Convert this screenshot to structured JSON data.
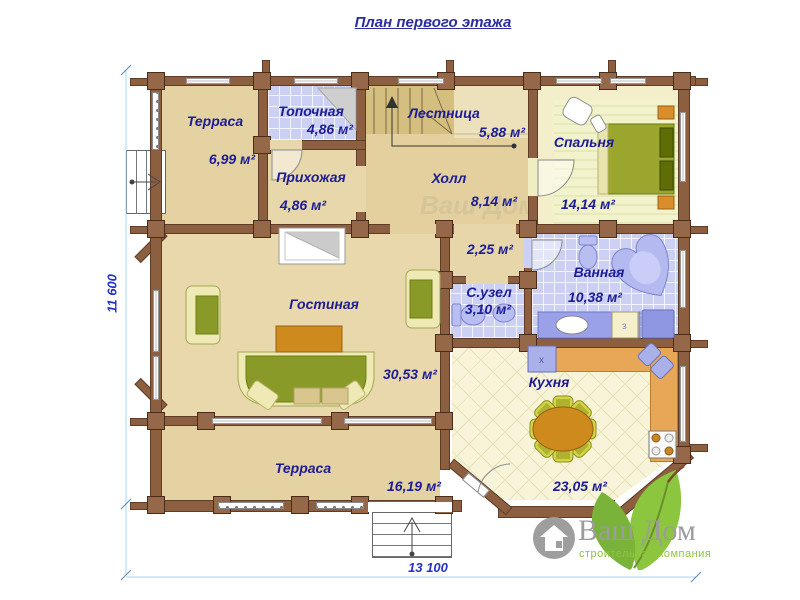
{
  "title": "План первого этажа",
  "dimension_labels": {
    "vertical": "11 600",
    "horizontal": "13 100"
  },
  "rooms": {
    "terrace_top": {
      "name": "Терраса",
      "area": "6,99 м²"
    },
    "boiler": {
      "name": "Топочная",
      "area": "4,86 м²"
    },
    "entry_hall": {
      "name": "Прихожая",
      "area": "4,86 м²"
    },
    "stairs": {
      "name": "Лестница",
      "area": "5,88 м²"
    },
    "hall": {
      "name": "Холл",
      "area": "8,14 м²"
    },
    "bedroom": {
      "name": "Спальня",
      "area": "14,14 м²"
    },
    "corridor": {
      "area": "2,25 м²"
    },
    "wc": {
      "name": "С.узел",
      "area": "3,10 м²"
    },
    "bathroom": {
      "name": "Ванная",
      "area": "10,38 м²"
    },
    "living_room": {
      "name": "Гостиная",
      "area": "30,53 м²"
    },
    "kitchen": {
      "name": "Кухня",
      "area": "23,05 м²"
    },
    "terrace_bottom": {
      "name": "Терраса",
      "area": "16,19 м²"
    }
  },
  "bathroom_cabinet_label": "з",
  "kitchen_appliance_label": "x",
  "watermark": "Ваш Дом",
  "logo": {
    "name": "Ваш Дом",
    "subtitle": "строительная компания"
  },
  "colors": {
    "label_blue": "#1c1c96",
    "dimension_blue": "#2233cc",
    "wall_brown": "#8d5f41",
    "tile_blue": "#ccd1f4",
    "floor_tan": "#e7d6a9",
    "logo_green": "#8cc63e",
    "logo_gray": "#9c9c9c"
  }
}
